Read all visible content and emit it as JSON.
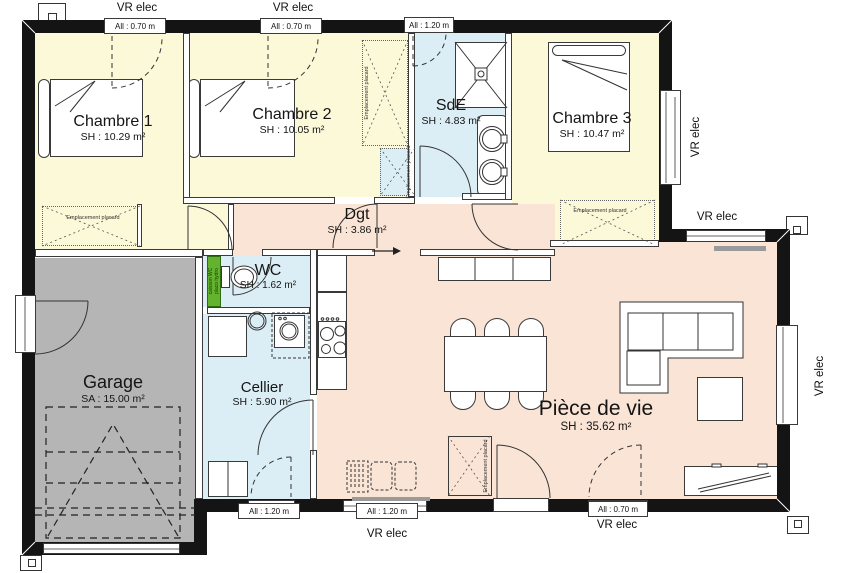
{
  "rooms": {
    "chambre1": {
      "name": "Chambre 1",
      "area": "SH : 10.29 m²"
    },
    "chambre2": {
      "name": "Chambre 2",
      "area": "SH : 10.05 m²"
    },
    "sde": {
      "name": "SdE",
      "area": "SH : 4.83 m²"
    },
    "chambre3": {
      "name": "Chambre 3",
      "area": "SH : 10.47 m²"
    },
    "dgt": {
      "name": "Dgt",
      "area": "SH : 3.86 m²"
    },
    "wc": {
      "name": "WC",
      "area": "SH : 1.62 m²"
    },
    "garage": {
      "name": "Garage",
      "area": "SA : 15.00 m²"
    },
    "cellier": {
      "name": "Cellier",
      "area": "SH : 5.90 m²"
    },
    "piece_de_vie": {
      "name": "Pièce de vie",
      "area": "SH : 35.62 m²"
    }
  },
  "windows": [
    {
      "id": "chambre1-top",
      "sill": "All : 0.70 m",
      "shutter": "VR elec"
    },
    {
      "id": "chambre2-top",
      "sill": "All : 0.70 m",
      "shutter": "VR elec"
    },
    {
      "id": "sde-top",
      "sill": "All : 1.20 m",
      "shutter": ""
    },
    {
      "id": "chambre3-right",
      "sill": "",
      "shutter": "VR elec"
    },
    {
      "id": "piece-de-vie-top",
      "sill": "",
      "shutter": "VR elec"
    },
    {
      "id": "piece-de-vie-right",
      "sill": "",
      "shutter": "VR elec"
    },
    {
      "id": "cellier-bottom",
      "sill": "All : 1.20 m",
      "shutter": ""
    },
    {
      "id": "cuisine-bottom",
      "sill": "All : 1.20 m",
      "shutter": "VR elec"
    },
    {
      "id": "piece-de-vie-bottom",
      "sill": "All : 0.70 m",
      "shutter": "VR elec"
    }
  ],
  "labels": {
    "placard": "Emplacement placard",
    "caisson_l1": "caisson WC",
    "caisson_l2": "placo hydro"
  },
  "colors": {
    "bedroom_fill": "#FBF9D8",
    "wet_fill": "#DCEEF5",
    "living_fill": "#FAE4D6",
    "garage_fill": "#B5B5B5",
    "caisson_green": "#63B32E",
    "wall": "#141414"
  }
}
